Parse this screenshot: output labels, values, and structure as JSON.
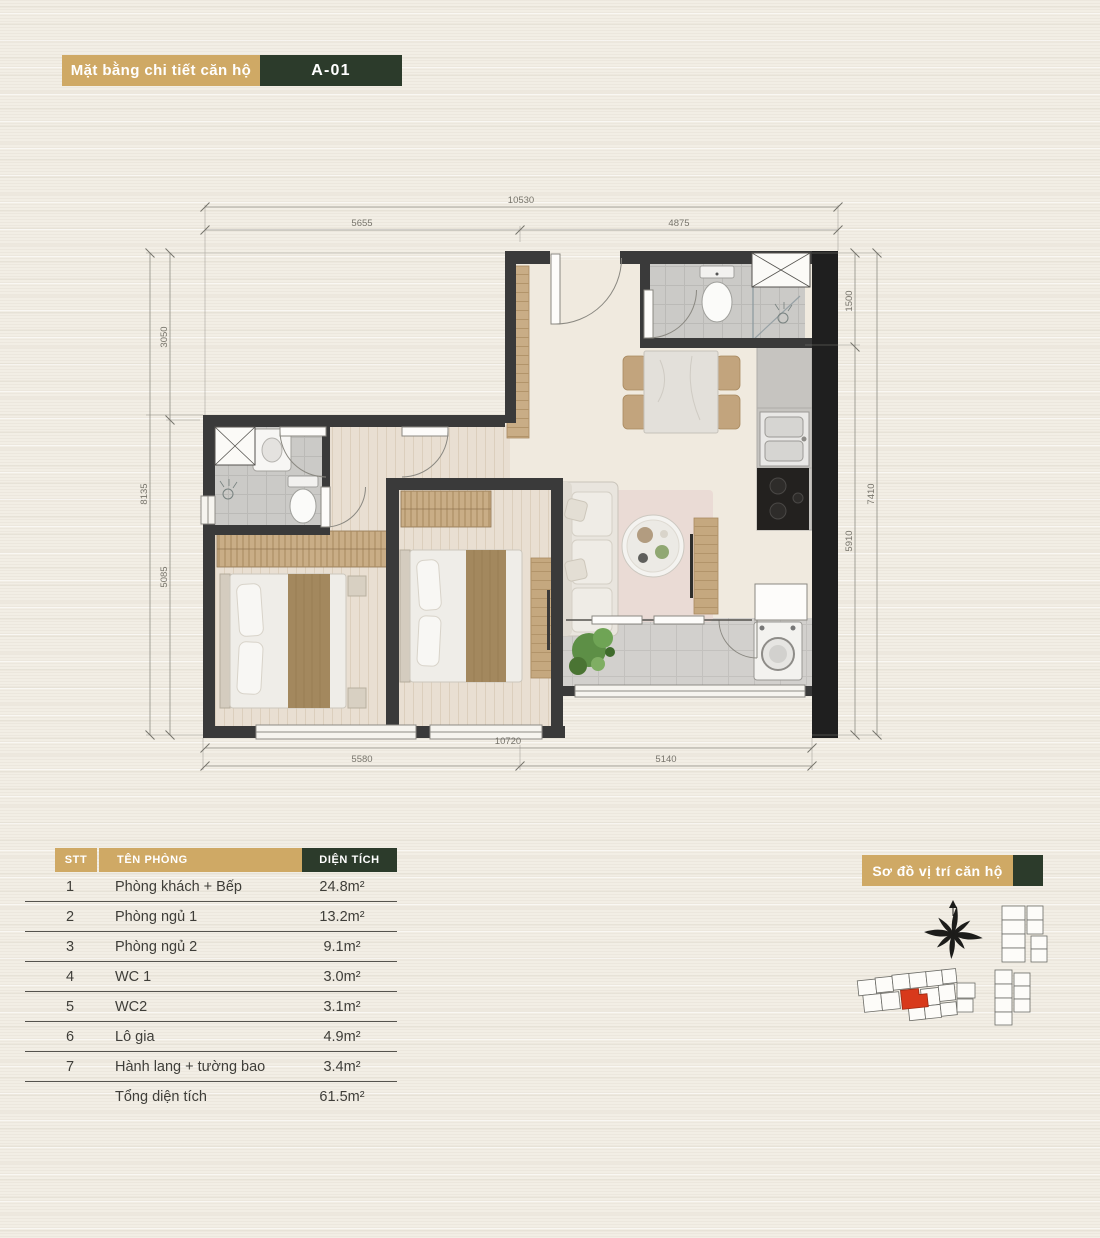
{
  "title_banner": {
    "label": "Mặt bằng chi tiết căn hộ",
    "unit_code": "A-01"
  },
  "location_banner": {
    "label": "Sơ đồ vị trí căn hộ"
  },
  "colors": {
    "accent_tan": "#cfa965",
    "accent_green": "#2c3b2b",
    "highlight_unit_red": "#d8391b",
    "wall_dark": "#3a3a3a",
    "background_cream": "#f2eee5"
  },
  "floor_plan": {
    "dimensions": {
      "top_total": "10530",
      "top_left": "5655",
      "top_right": "4875",
      "left_total": "8135",
      "left_top": "3050",
      "left_bottom": "5085",
      "right_total": "7410",
      "right_top": "1500",
      "right_bottom": "5910",
      "bottom_total": "10720",
      "bottom_left": "5580",
      "bottom_right": "5140"
    }
  },
  "area_table": {
    "headers": {
      "stt": "STT",
      "room": "TÊN PHÒNG",
      "area": "DIỆN TÍCH"
    },
    "rows": [
      {
        "stt": "1",
        "room": "Phòng khách + Bếp",
        "area": "24.8m²"
      },
      {
        "stt": "2",
        "room": "Phòng ngủ 1",
        "area": "13.2m²"
      },
      {
        "stt": "3",
        "room": "Phòng ngủ 2",
        "area": "9.1m²"
      },
      {
        "stt": "4",
        "room": "WC 1",
        "area": "3.0m²"
      },
      {
        "stt": "5",
        "room": "WC2",
        "area": "3.1m²"
      },
      {
        "stt": "6",
        "room": "Lô gia",
        "area": "4.9m²"
      },
      {
        "stt": "7",
        "room": "Hành lang + tường bao",
        "area": "3.4m²"
      }
    ],
    "total": {
      "label": "Tổng diện tích",
      "area": "61.5m²"
    }
  }
}
